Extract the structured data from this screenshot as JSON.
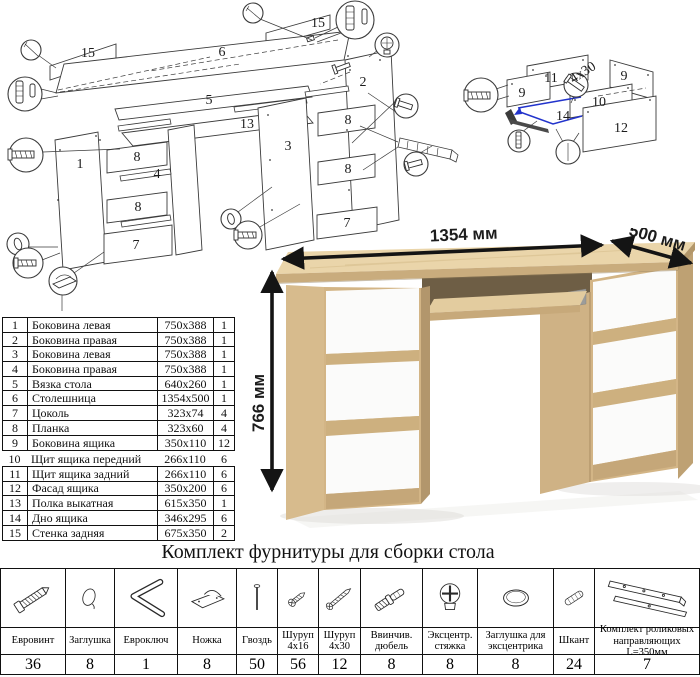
{
  "diagram": {
    "part_labels": [
      {
        "t": "15",
        "x": 88,
        "y": 57
      },
      {
        "t": "6",
        "x": 222,
        "y": 56
      },
      {
        "t": "15",
        "x": 318,
        "y": 27
      },
      {
        "t": "2",
        "x": 363,
        "y": 86
      },
      {
        "t": "5",
        "x": 209,
        "y": 104
      },
      {
        "t": "13",
        "x": 247,
        "y": 128
      },
      {
        "t": "3",
        "x": 288,
        "y": 150
      },
      {
        "t": "1",
        "x": 80,
        "y": 168
      },
      {
        "t": "8",
        "x": 137,
        "y": 161
      },
      {
        "t": "4",
        "x": 157,
        "y": 178
      },
      {
        "t": "8",
        "x": 138,
        "y": 211
      },
      {
        "t": "7",
        "x": 136,
        "y": 249
      },
      {
        "t": "8",
        "x": 348,
        "y": 124
      },
      {
        "t": "8",
        "x": 348,
        "y": 173
      },
      {
        "t": "7",
        "x": 347,
        "y": 227
      },
      {
        "t": "11",
        "x": 551,
        "y": 82
      },
      {
        "t": "9",
        "x": 624,
        "y": 80
      },
      {
        "t": "9",
        "x": 522,
        "y": 97
      },
      {
        "t": "10",
        "x": 599,
        "y": 106
      },
      {
        "t": "14",
        "x": 563,
        "y": 120
      },
      {
        "t": "12",
        "x": 621,
        "y": 132
      },
      {
        "t": "4x30",
        "x": 585,
        "y": 76,
        "r": -33,
        "i": 1,
        "fs": 11
      }
    ]
  },
  "parts_table": {
    "rows": [
      {
        "num": "1",
        "name": "Боковина левая",
        "size": "750x388",
        "qty": "1"
      },
      {
        "num": "2",
        "name": "Боковина правая",
        "size": "750x388",
        "qty": "1"
      },
      {
        "num": "3",
        "name": "Боковина левая",
        "size": "750x388",
        "qty": "1"
      },
      {
        "num": "4",
        "name": "Боковина правая",
        "size": "750x388",
        "qty": "1"
      },
      {
        "num": "5",
        "name": "Вязка стола",
        "size": "640x260",
        "qty": "1"
      },
      {
        "num": "6",
        "name": "Столешница",
        "size": "1354x500",
        "qty": "1"
      },
      {
        "num": "7",
        "name": "Цоколь",
        "size": "323x74",
        "qty": "4"
      },
      {
        "num": "8",
        "name": "Планка",
        "size": "323x60",
        "qty": "4"
      },
      {
        "num": "9",
        "name": "Боковина ящика",
        "size": "350x110",
        "qty": "12"
      },
      {
        "num": "10",
        "name": "Щит ящика передний",
        "size": "266x110",
        "qty": "6"
      },
      {
        "num": "11",
        "name": "Щит ящика задний",
        "size": "266x110",
        "qty": "6"
      },
      {
        "num": "12",
        "name": "Фасад ящика",
        "size": "350x200",
        "qty": "6"
      },
      {
        "num": "13",
        "name": "Полка выкатная",
        "size": "615x350",
        "qty": "1"
      },
      {
        "num": "14",
        "name": "Дно ящика",
        "size": "346x295",
        "qty": "6"
      },
      {
        "num": "15",
        "name": "Стенка задняя",
        "size": "675x350",
        "qty": "2"
      }
    ]
  },
  "desk": {
    "width_label": "1354 мм",
    "depth_label": "500 мм",
    "height_label": "766 мм"
  },
  "hardware": {
    "title": "Комплект фурнитуры для сборки стола",
    "items": [
      {
        "name": "Евровинт",
        "qty": "36",
        "icon": "euroscrew"
      },
      {
        "name": "Заглушка",
        "qty": "8",
        "icon": "cap"
      },
      {
        "name": "Евроключ",
        "qty": "1",
        "icon": "hexkey"
      },
      {
        "name": "Ножка",
        "qty": "8",
        "icon": "foot"
      },
      {
        "name": "Гвоздь",
        "qty": "50",
        "icon": "nail"
      },
      {
        "name": "Шуруп 4x16",
        "qty": "56",
        "icon": "screw-short"
      },
      {
        "name": "Шуруп 4x30",
        "qty": "12",
        "icon": "screw-long"
      },
      {
        "name": "Ввинчив. дюбель",
        "qty": "8",
        "icon": "dowel-screw"
      },
      {
        "name": "Эксцентр. стяжка",
        "qty": "8",
        "icon": "cam"
      },
      {
        "name": "Заглушка для эксцентрика",
        "qty": "8",
        "icon": "cam-cap"
      },
      {
        "name": "Шкант",
        "qty": "24",
        "icon": "wood-dowel"
      },
      {
        "name": "Комплект роликовых направляющих L=350мм",
        "qty": "7",
        "icon": "rails"
      }
    ]
  }
}
